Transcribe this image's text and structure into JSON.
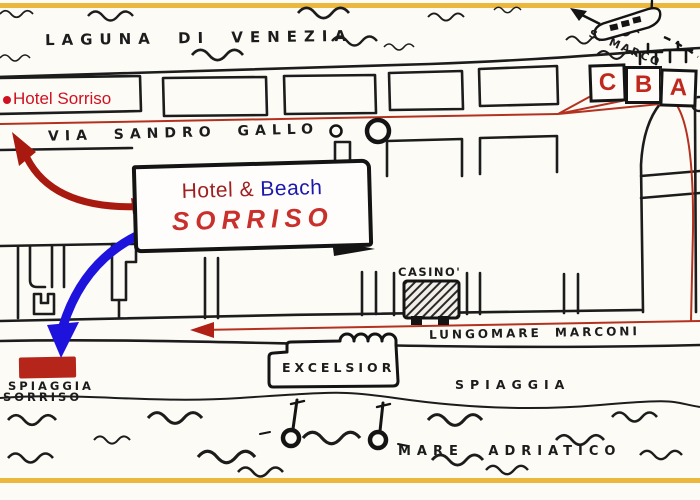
{
  "map": {
    "water_top_label": "LAGUNA  DI VENEZIA",
    "hotel_marker_label": "Hotel Sorriso",
    "street_top_label": "VIA  SANDRO  GALLO",
    "ferry_destination_label": "S. MARCO",
    "stops": [
      "C",
      "B",
      "A"
    ],
    "callout": {
      "line1_red": "Hotel &",
      "line1_blue": "Beach",
      "line2": "SORRISO"
    },
    "casino_label": "CASINO'",
    "street_bottom_label": "LUNGOMARE  MARCONI",
    "excelsior_label": "EXCELSIOR",
    "beach_marker_line1": "SPIAGGIA",
    "beach_marker_line2": "SORRISO",
    "beach_label": "SPIAGGIA",
    "sea_label": "MARE  ADRIATICO",
    "colors": {
      "ink": "#1c1c1c",
      "frame_yellow": "#ecb73d",
      "marker_red": "#d01020",
      "route_red": "#b5311f",
      "arrow_dark_red": "#a81a10",
      "arrow_blue": "#1d13dd",
      "beach_rect_red": "#b5251a",
      "stop_letter_red": "#c0281e",
      "callout_red": "#9e2020",
      "callout_blue": "#1a17ad",
      "sorriso_red": "#c9302c"
    }
  }
}
